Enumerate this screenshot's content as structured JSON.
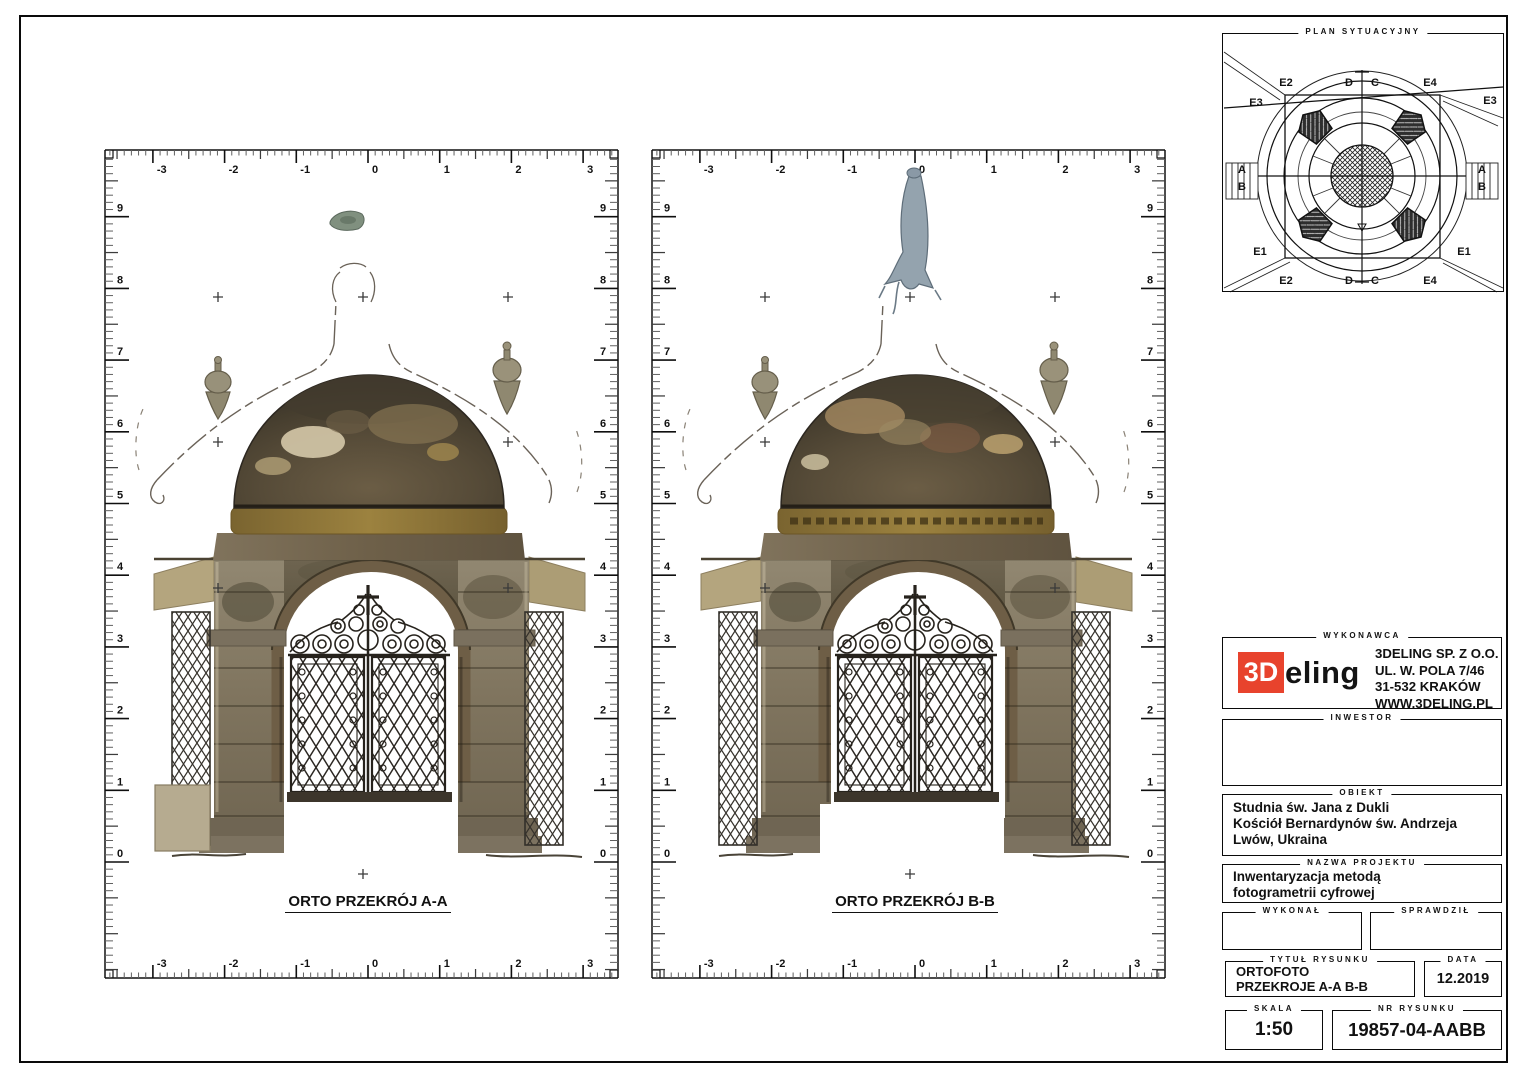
{
  "panels": [
    {
      "caption": "ORTO PRZEKRÓJ A-A"
    },
    {
      "caption": "ORTO PRZEKRÓJ B-B"
    }
  ],
  "rulers": {
    "unit_px": 71.7,
    "origin_y": 862,
    "panel_origins_x": [
      368,
      915
    ],
    "h_labels": [
      "-3",
      "-2",
      "-1",
      "0",
      "1",
      "2",
      "3"
    ],
    "v_labels": [
      "0",
      "1",
      "2",
      "3",
      "4",
      "5",
      "6",
      "7",
      "8",
      "9"
    ]
  },
  "plan": {
    "title": "PLAN SYTUACYJNY",
    "labels": {
      "e1": "E1",
      "e2": "E2",
      "e3": "E3",
      "e4": "E4",
      "a": "A",
      "b": "B",
      "c": "C",
      "d": "D"
    }
  },
  "title_block": {
    "wykonawca": {
      "label": "WYKONAWCA",
      "logo_3d": "3D",
      "logo_rest": "eling",
      "logo_red": "#e8432d",
      "company": "3DELING SP. Z O.O.",
      "address1": "UL. W. POLA 7/46",
      "address2": "31-532 KRAKÓW",
      "website": "WWW.3DELING.PL"
    },
    "inwestor": {
      "label": "INWESTOR",
      "value": ""
    },
    "obiekt": {
      "label": "OBIEKT",
      "line1": "Studnia św. Jana z Dukli",
      "line2": "Kościół Bernardynów św. Andrzeja",
      "line3": "Lwów, Ukraina"
    },
    "nazwa_projektu": {
      "label": "NAZWA PROJEKTU",
      "line1": "Inwentaryzacja metodą",
      "line2": "fotogrametrii cyfrowej"
    },
    "wykonal": {
      "label": "WYKONAŁ",
      "value": ""
    },
    "sprawdzil": {
      "label": "SPRAWDZIŁ",
      "value": ""
    },
    "tytul": {
      "label": "TYTUŁ RYSUNKU",
      "line1": "ORTOFOTO",
      "line2": "PRZEKROJE A-A B-B"
    },
    "data_box": {
      "label": "DATA",
      "value": "12.2019"
    },
    "skala": {
      "label": "SKALA",
      "value": "1:50"
    },
    "nr": {
      "label": "NR RYSUNKU",
      "value": "19857-04-AABB"
    }
  }
}
